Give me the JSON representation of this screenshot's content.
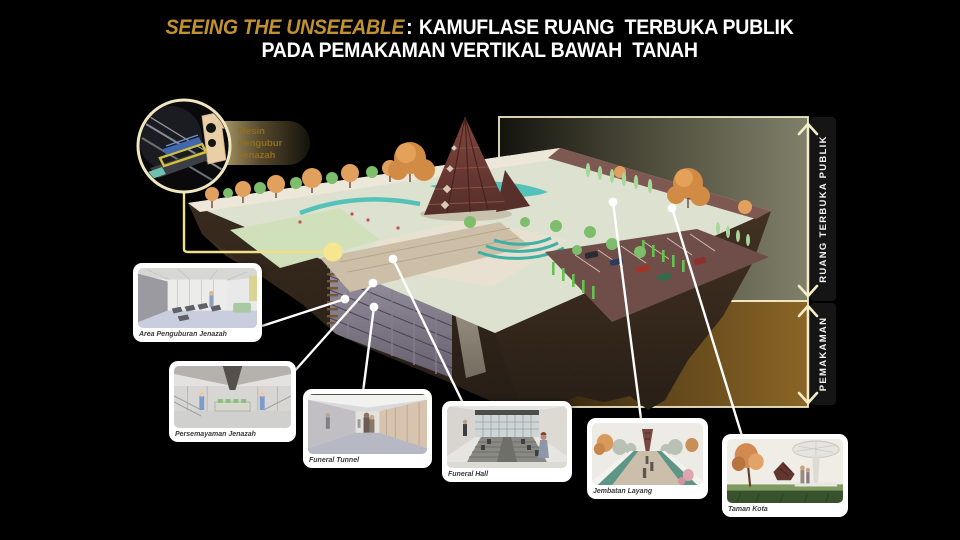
{
  "slide": {
    "title": {
      "highlight": "SEEING THE UNSEEABLE",
      "colon": ":",
      "line1_rest": "KAMUFLASE RUANG  TERBUKA PUBLIK",
      "line2": "PADA PEMAKAMAN VERTIKAL BAWAH  TANAH"
    },
    "machine_callout": {
      "line1": "Mesin",
      "line2": "Pengubur",
      "line3": "Jenazah"
    },
    "axis": {
      "top_label": "RUANG TERBUKA PUBLIK",
      "bottom_label": "PEMAKAMAN"
    },
    "cards": [
      {
        "label": "Area Penguburan Jenazah"
      },
      {
        "label": "Persemayaman Jenazah"
      },
      {
        "label": "Funeral Tunnel"
      },
      {
        "label": "Funeral Hall"
      },
      {
        "label": "Jembatan Layang"
      },
      {
        "label": "Taman Kota"
      }
    ],
    "colors": {
      "title_accent": "#C2922F",
      "cream_outline": "#F2ECC9",
      "callout_dot": "#F6E78F",
      "panel_olive": "#7A7A63",
      "panel_brown": "#7E5C23",
      "label_strip": "#151515",
      "connector": "#FFFFFF",
      "church": "#74403A",
      "soil": "#32251A"
    }
  }
}
